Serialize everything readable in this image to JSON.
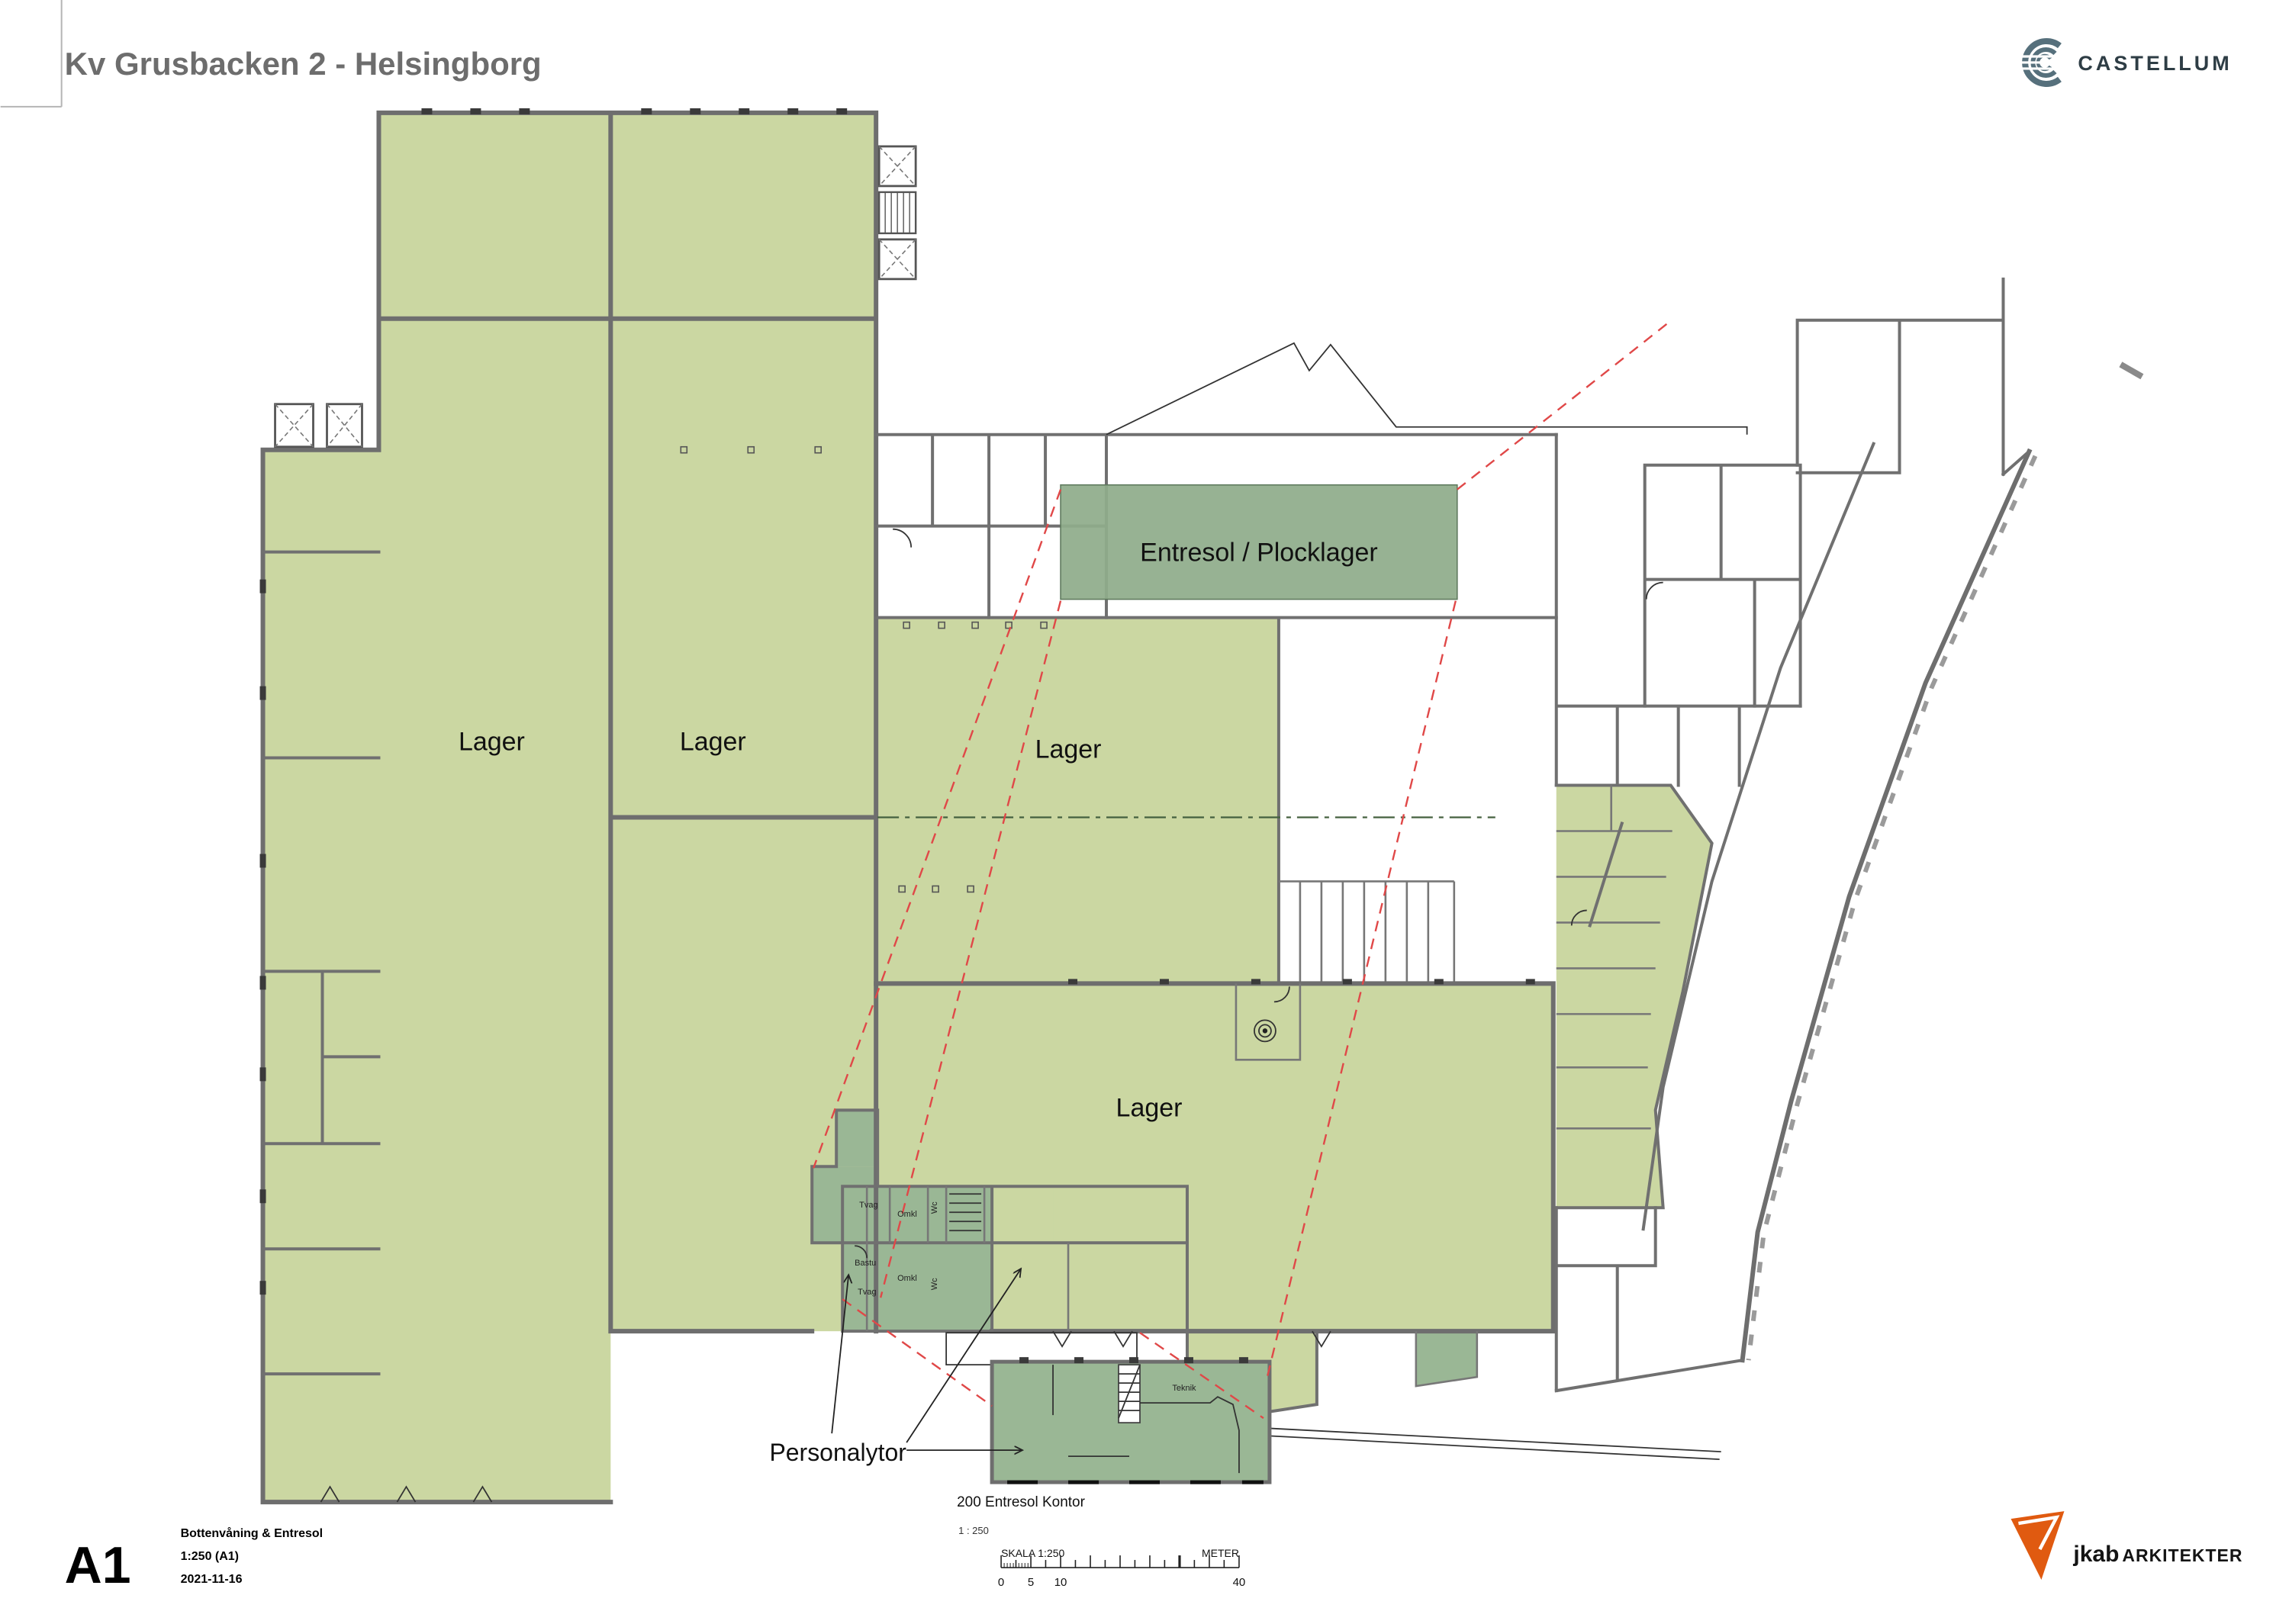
{
  "header": {
    "title": "Kv Grusbacken 2 - Helsingborg"
  },
  "branding": {
    "castellum": "CASTELLUM",
    "jkab": "jkab",
    "jkab_suffix": "ARKITEKTER"
  },
  "plan": {
    "areas": {
      "lager_1": "Lager",
      "lager_2": "Lager",
      "lager_3": "Lager",
      "lager_4": "Lager",
      "entresol_overlay": "Entresol / Plocklager"
    },
    "annotations": {
      "personalytor": "Personalytor"
    },
    "rooms": {
      "tvag_1": "Tvag",
      "omkl_1": "Omkl",
      "wc_1": "Wc",
      "bastu": "Bastu",
      "omkl_2": "Omkl",
      "tvag_2": "Tvag",
      "wc_2": "Wc",
      "teknik": "Teknik"
    },
    "colors": {
      "warehouse_green": "#cbd7a2",
      "mezzanine_green": "#8fac8b",
      "staff_green": "#9ab795",
      "wall_gray": "#6e6e6e",
      "red_dashed": "#e04848",
      "jkab_orange": "#e05a10",
      "castellum_gray": "#56707c"
    }
  },
  "detail": {
    "title": "200 Entresol Kontor",
    "scale": "1 : 250"
  },
  "scalebar": {
    "label": "SKALA  1:250",
    "unit": "METER",
    "ticks": [
      "0",
      "5",
      "10",
      "40"
    ]
  },
  "title_block": {
    "sheet_size": "A1",
    "line_1": "Bottenvåning & Entresol",
    "line_2": "1:250 (A1)",
    "line_3": "2021-11-16"
  }
}
